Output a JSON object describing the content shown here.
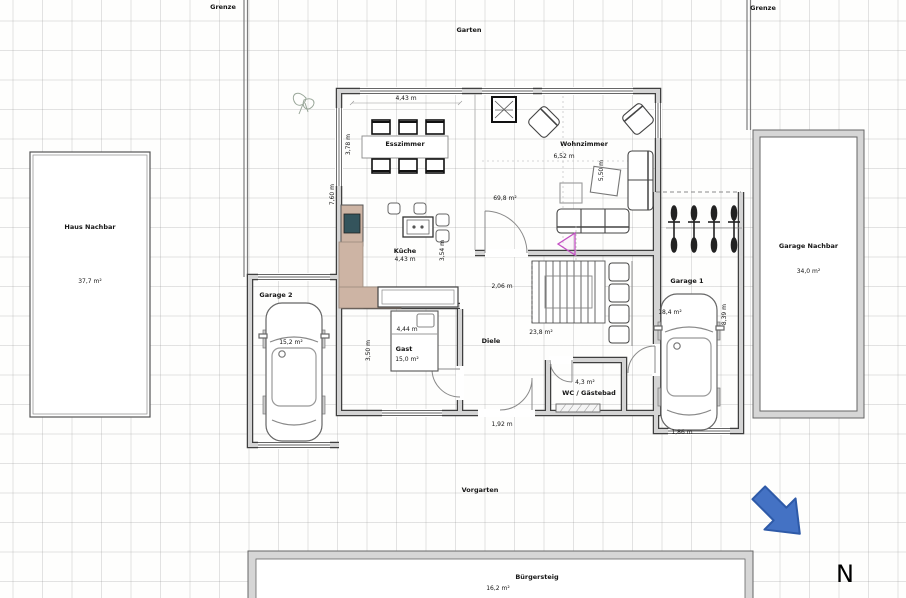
{
  "site": {
    "grenze_left": "Grenze",
    "grenze_right": "Grenze",
    "garten": "Garten",
    "vorgarten": "Vorgarten",
    "buergersteig": "Bürgersteig",
    "buergersteig_area": "16,2 m²",
    "north": "N"
  },
  "neighbor": {
    "house": "Haus Nachbar",
    "house_area": "37,7 m²",
    "garage": "Garage Nachbar",
    "garage_area": "34,0 m²"
  },
  "rooms": {
    "esszimmer": "Esszimmer",
    "wohnzimmer": "Wohnzimmer",
    "kueche": "Küche",
    "diele": "Diele",
    "gast": "Gast",
    "wc": "WC / Gästebad",
    "garage1": "Garage 1",
    "garage2": "Garage 2"
  },
  "areas": {
    "open_living": "69,8 m²",
    "diele": "23,8 m²",
    "gast": "15,0 m²",
    "wc": "4,3 m²",
    "garage1": "18,4 m²",
    "garage2": "15,2 m²"
  },
  "dims": {
    "esszimmer_w": "4,43 m",
    "esszimmer_d": "3,78 m",
    "west_wing_d": "7,60 m",
    "wohnzimmer_w": "6,52 m",
    "wohnzimmer_d": "5,50 m",
    "flur_w": "2,06 m",
    "kueche_w": "4,43 m",
    "kueche_d": "3,54 m",
    "gast_w": "4,44 m",
    "gast_d": "3,50 m",
    "entry_w": "1,92 m",
    "garage1_d": "8,39 m",
    "garage1_door_w": "1,86 m"
  },
  "colors": {
    "north_arrow": "#4472c4",
    "north_arrow_border": "#2e5aa8",
    "wall_fill": "#d4d4d4",
    "wall_edge": "#3f3f3f",
    "counter_tan": "#cdb4a4",
    "teal_inset": "#34545c",
    "tv_magenta": "#c44fc4"
  }
}
